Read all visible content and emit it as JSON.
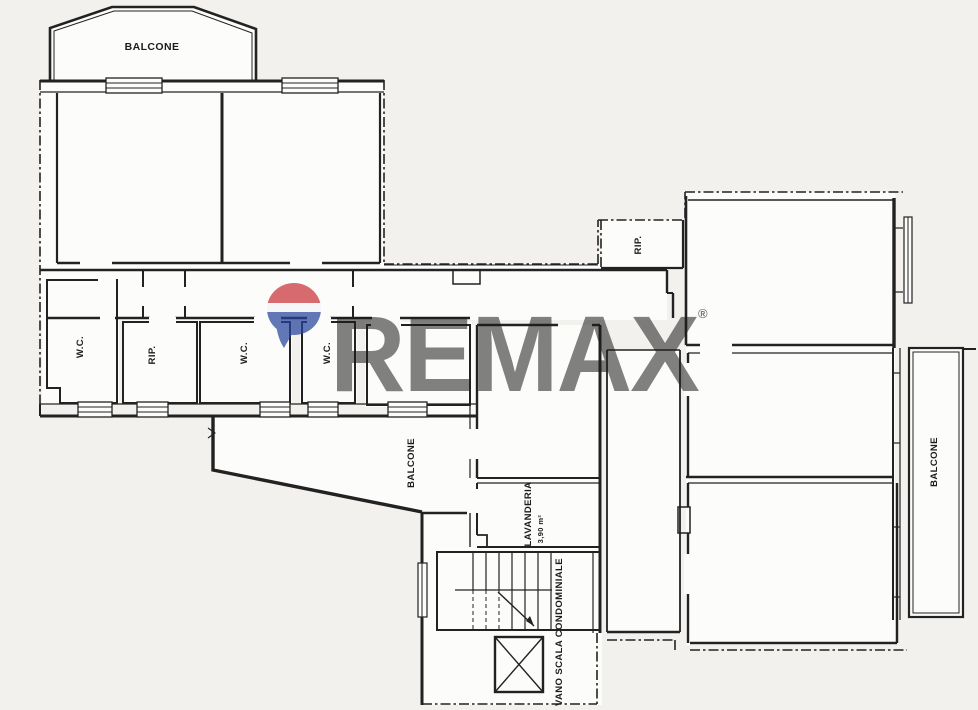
{
  "labels": {
    "balcone_top": "BALCONE",
    "wc_left": "W.C.",
    "rip_left": "RIP.",
    "wc_center": "W.C.",
    "wc_right": "W.C.",
    "rip_right": "RIP.",
    "balcone_lower": "BALCONE",
    "lavanderia_name": "LAVANDERIA",
    "lavanderia_area": "3,90 m²",
    "vano_scala": "VANO SCALA CONDOMINIALE",
    "balcone_right": "BALCONE"
  },
  "watermark": {
    "brand": "REMAX",
    "registered": "®"
  },
  "colors": {
    "ink": "#1f1f1f",
    "paper": "#f2f1ed",
    "room_fill": "#fcfcfa",
    "watermark_gray": "#b9b9b9",
    "balloon_red": "#c8323a",
    "balloon_blue": "#27449c"
  }
}
